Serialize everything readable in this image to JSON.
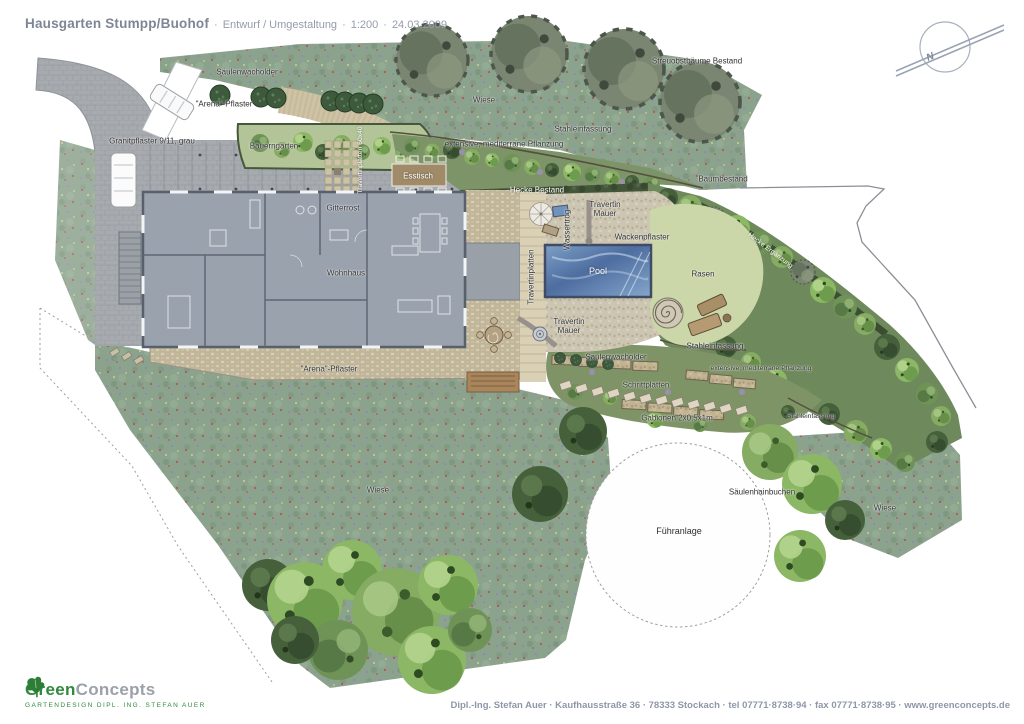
{
  "header": {
    "title": "Hausgarten Stumpp/Buohof",
    "separator": "·",
    "subtitle": [
      "Entwurf / Umgestaltung",
      "1:200",
      "24.03.2009"
    ]
  },
  "plan": {
    "labels": [
      {
        "id": "saeulenwacholder-top",
        "text": "Säulenwacholder"
      },
      {
        "id": "arena-pflaster-top",
        "text": "\"Arena\"-Pflaster"
      },
      {
        "id": "granitpflaster",
        "text": "Granitpflaster 9/11, grau"
      },
      {
        "id": "bauerngarten",
        "text": "Bauerngarten"
      },
      {
        "id": "wiese-top",
        "text": "Wiese"
      },
      {
        "id": "streuobstbaeume-bestand",
        "text": "Streuobstbäume Bestand"
      },
      {
        "id": "stahleinfassung-top",
        "text": "Stahleinfassung"
      },
      {
        "id": "extensive-pflanzung-top",
        "text": "extensive, mediterrane Pflanzung"
      },
      {
        "id": "hecke-bestand",
        "text": "Hecke Bestand"
      },
      {
        "id": "baumbestand",
        "text": "Baumbestand"
      },
      {
        "id": "travertin-mauer-top",
        "text": "Travertin\nMauer"
      },
      {
        "id": "wassertrog",
        "text": "Wassertrog"
      },
      {
        "id": "wackenpflaster",
        "text": "Wackenpflaster"
      },
      {
        "id": "travertinplatten-pool",
        "text": "Travertinplatten"
      },
      {
        "id": "travertinplatten-terrasse",
        "text": "Travertinplatten 60x40"
      },
      {
        "id": "esstisch",
        "text": "Esstisch"
      },
      {
        "id": "gitterrost",
        "text": "Gitterrost"
      },
      {
        "id": "wohnhaus",
        "text": "Wohnhaus"
      },
      {
        "id": "arena-pflaster-bottom",
        "text": "\"Arena\"-Pflaster"
      },
      {
        "id": "pool",
        "text": "Pool"
      },
      {
        "id": "rasen",
        "text": "Rasen"
      },
      {
        "id": "hecke-ergaenzung",
        "text": "Hecke Ergänzung"
      },
      {
        "id": "travertin-mauer-mid",
        "text": "Travertin\nMauer"
      },
      {
        "id": "stahleinfassung-mid",
        "text": "Stahleinfassung"
      },
      {
        "id": "saeulenwacholder-mid",
        "text": "Säulenwacholder"
      },
      {
        "id": "extensive-pflanzung-mid",
        "text": "extensive, mediterrane Pflanzung"
      },
      {
        "id": "schrittplatten",
        "text": "Schrittplatten"
      },
      {
        "id": "gabionen",
        "text": "Gabionen 2x0,5x1m"
      },
      {
        "id": "stahleinfassung-right",
        "text": "Stahleinfassung"
      },
      {
        "id": "saeulenhainbuchen",
        "text": "Säulenhainbuchen"
      },
      {
        "id": "wiese-right",
        "text": "Wiese"
      },
      {
        "id": "fuehranlage",
        "text": "Führanlage"
      },
      {
        "id": "wiese-left",
        "text": "Wiese"
      }
    ]
  },
  "compass": {
    "letter": "N"
  },
  "footer": {
    "logo": {
      "word1": "Green",
      "word2": "Concepts",
      "tagline": "GARTENDESIGN DIPL. ING. STEFAN AUER",
      "leaf_icon": "ivy-leaf",
      "accent_green": "#2f8a3d",
      "gray": "#9aa1a8"
    },
    "address": "Dipl.-Ing. Stefan Auer · Kaufhausstraße 36 · 78333 Stockach · tel 07771·8738·94 · fax 07771·8738·95 · www.greenconcepts.de"
  },
  "palette": {
    "meadow": "#8ba28c",
    "lawn": "#cbd7a9",
    "pool_blue": "#5a7cae",
    "pavement_gray": "#a7abaf",
    "travertine": "#d9d0b5",
    "house_gray": "#9aa2ae",
    "hedge_dark": "#44563a",
    "title_gray": "#7d8695"
  }
}
